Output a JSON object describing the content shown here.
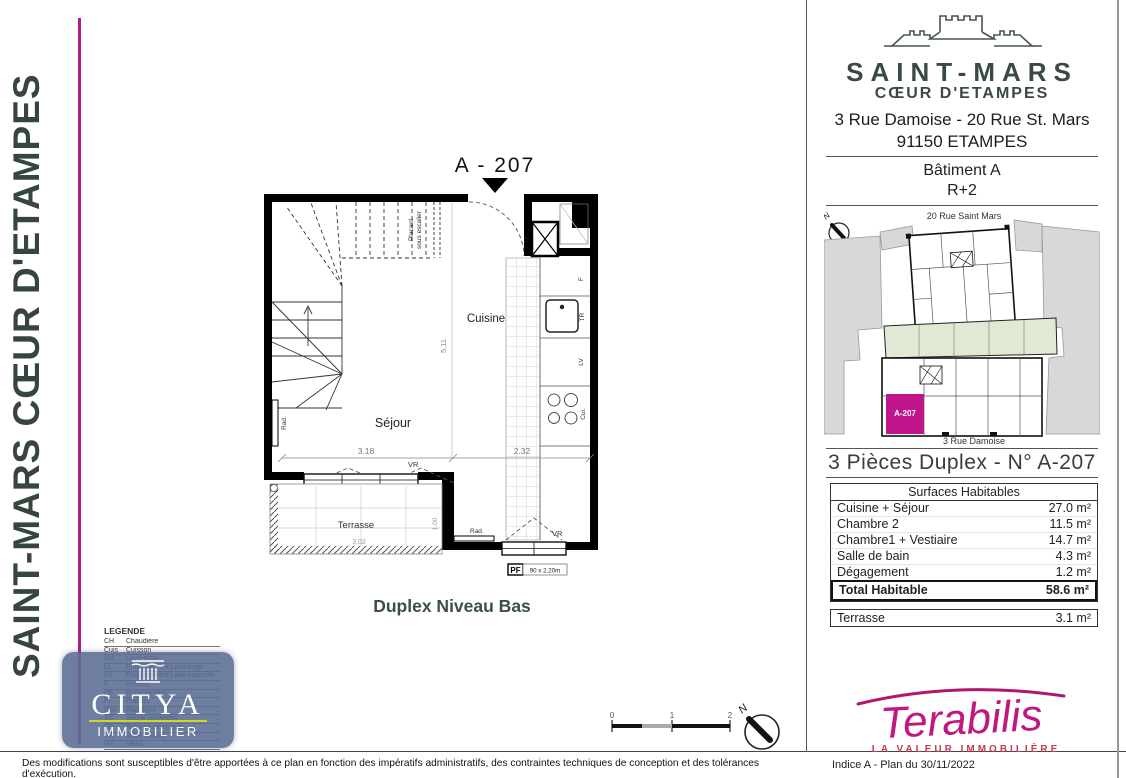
{
  "banner": {
    "text": "SAINT-MARS CŒUR D'ETAMPES",
    "accent_color": "#b01d82"
  },
  "watermark": {
    "name": "CITYA",
    "subtitle": "IMMOBILIER"
  },
  "plan": {
    "unit_title": "A - 207",
    "caption": "Duplex Niveau Bas",
    "room_cuisine": "Cuisine",
    "room_sejour": "Séjour",
    "room_terrasse": "Terrasse",
    "placard": "Placard",
    "placard2": "sous escalier",
    "dim_511": "5.11",
    "dim_318": "3.18",
    "dim_232": "2.32",
    "dim_302": "3.02",
    "dim_100": "1.00",
    "pf_label": "PF",
    "pf1_size": "2.10 x 2.00m",
    "pf2_size": "90 x 2.20m",
    "vr": "VR",
    "rad": "Rad.",
    "te": "TE",
    "f": "F",
    "tr": "TR",
    "lv": "LV",
    "cui": "Cui.",
    "north": "N"
  },
  "scale_bar": {
    "t0": "0",
    "t1": "1",
    "t2": "2"
  },
  "legend": {
    "title": "LEGENDE",
    "items": [
      [
        "CH",
        "Chaudière"
      ],
      [
        "Cuis",
        "Cuisson"
      ],
      [
        "LM",
        "Lave-main"
      ],
      [
        "LL",
        "Emplacement Lave-linge"
      ],
      [
        "LV",
        "Emplacement Lave-vaisselle"
      ],
      [
        "F",
        "Fenêtre"
      ],
      [
        "PF",
        "Porte-fenêtre"
      ],
      [
        "Pl",
        "Placard"
      ],
      [
        "Rad",
        "Radiateur"
      ],
      [
        "SS",
        "Sèche serviettes"
      ],
      [
        "TE",
        "Tableau électrique"
      ],
      [
        "VR",
        "Volet roulant"
      ],
      [
        "VX",
        "Velux"
      ]
    ]
  },
  "right_panel": {
    "brand": {
      "name": "SAINT-MARS",
      "subtitle": "CŒUR D'ETAMPES"
    },
    "address_line1": "3 Rue Damoise - 20 Rue St. Mars",
    "address_line2": "91150 ETAMPES",
    "building": "Bâtiment A",
    "floor": "R+2",
    "site_map": {
      "street_top": "20 Rue Saint Mars",
      "street_bottom": "3 Rue Damoise",
      "unit_label": "A-207",
      "unit_color": "#c0168c",
      "north": "N"
    },
    "unit_heading": "3 Pièces Duplex - N° A-207",
    "surface_table": {
      "header": "Surfaces Habitables",
      "rows": [
        [
          "Cuisine + Séjour",
          "27.0 m²"
        ],
        [
          "Chambre 2",
          "11.5 m²"
        ],
        [
          "Chambre1 + Vestiaire",
          "14.7 m²"
        ],
        [
          "Salle de bain",
          "4.3 m²"
        ],
        [
          "Dégagement",
          "1.2 m²"
        ]
      ],
      "total_label": "Total Habitable",
      "total_value": "58.6 m²",
      "extra_label": "Terrasse",
      "extra_value": "3.1 m²"
    },
    "agency": {
      "name": "Terabilis",
      "tagline": "LA VALEUR IMMOBILIÈRE",
      "color": "#c2177f"
    }
  },
  "footer": {
    "disclaimer": "Des modifications sont susceptibles d'être apportées à ce plan en fonction des impératifs administratifs, des contraintes techniques de conception et des tolérances d'exécution.",
    "revision": "Indice A  - Plan du 30/11/2022"
  }
}
